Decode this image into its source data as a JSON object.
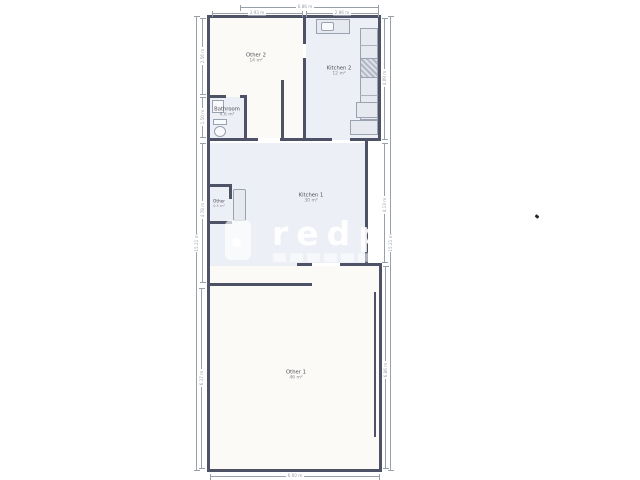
{
  "document": {
    "type": "floor-plan"
  },
  "rooms": {
    "other2": {
      "name": "Other 2",
      "area": "14 m²"
    },
    "kitchen2": {
      "name": "Kitchen 2",
      "area": "12 m²"
    },
    "bathroom": {
      "name": "Bathroom",
      "area": "4.6 m²"
    },
    "kitchen1": {
      "name": "Kitchen 1",
      "area": "30 m²"
    },
    "closet": {
      "name": "Other",
      "area": "0.5 m²"
    },
    "other1": {
      "name": "Other 1",
      "area": "46 m²"
    }
  },
  "dimensions": {
    "top_overall": "6.86 m",
    "top_left": "3.93 m",
    "top_right": "2.86 m",
    "left_outer": "15.21 m",
    "left_seg1": "2.56 m",
    "left_seg2": "1.50 m",
    "left_seg3": "4.78 m",
    "left_seg4": "6.17 m",
    "right_seg1": "4.09 m",
    "right_seg2": "4.13 m",
    "right_seg3": "6.86 m",
    "right_outer": "15.21 m",
    "bottom_overall": "6.60 m"
  },
  "watermark": {
    "brand": "redp"
  },
  "colors": {
    "wall": "#4e5266",
    "floor_warm": "#fbfaf6",
    "floor_cool": "#edeff6",
    "fixture_fill": "#e7e9f0",
    "fixture_border": "#9aa1af",
    "dimension": "#9aa0a8"
  }
}
